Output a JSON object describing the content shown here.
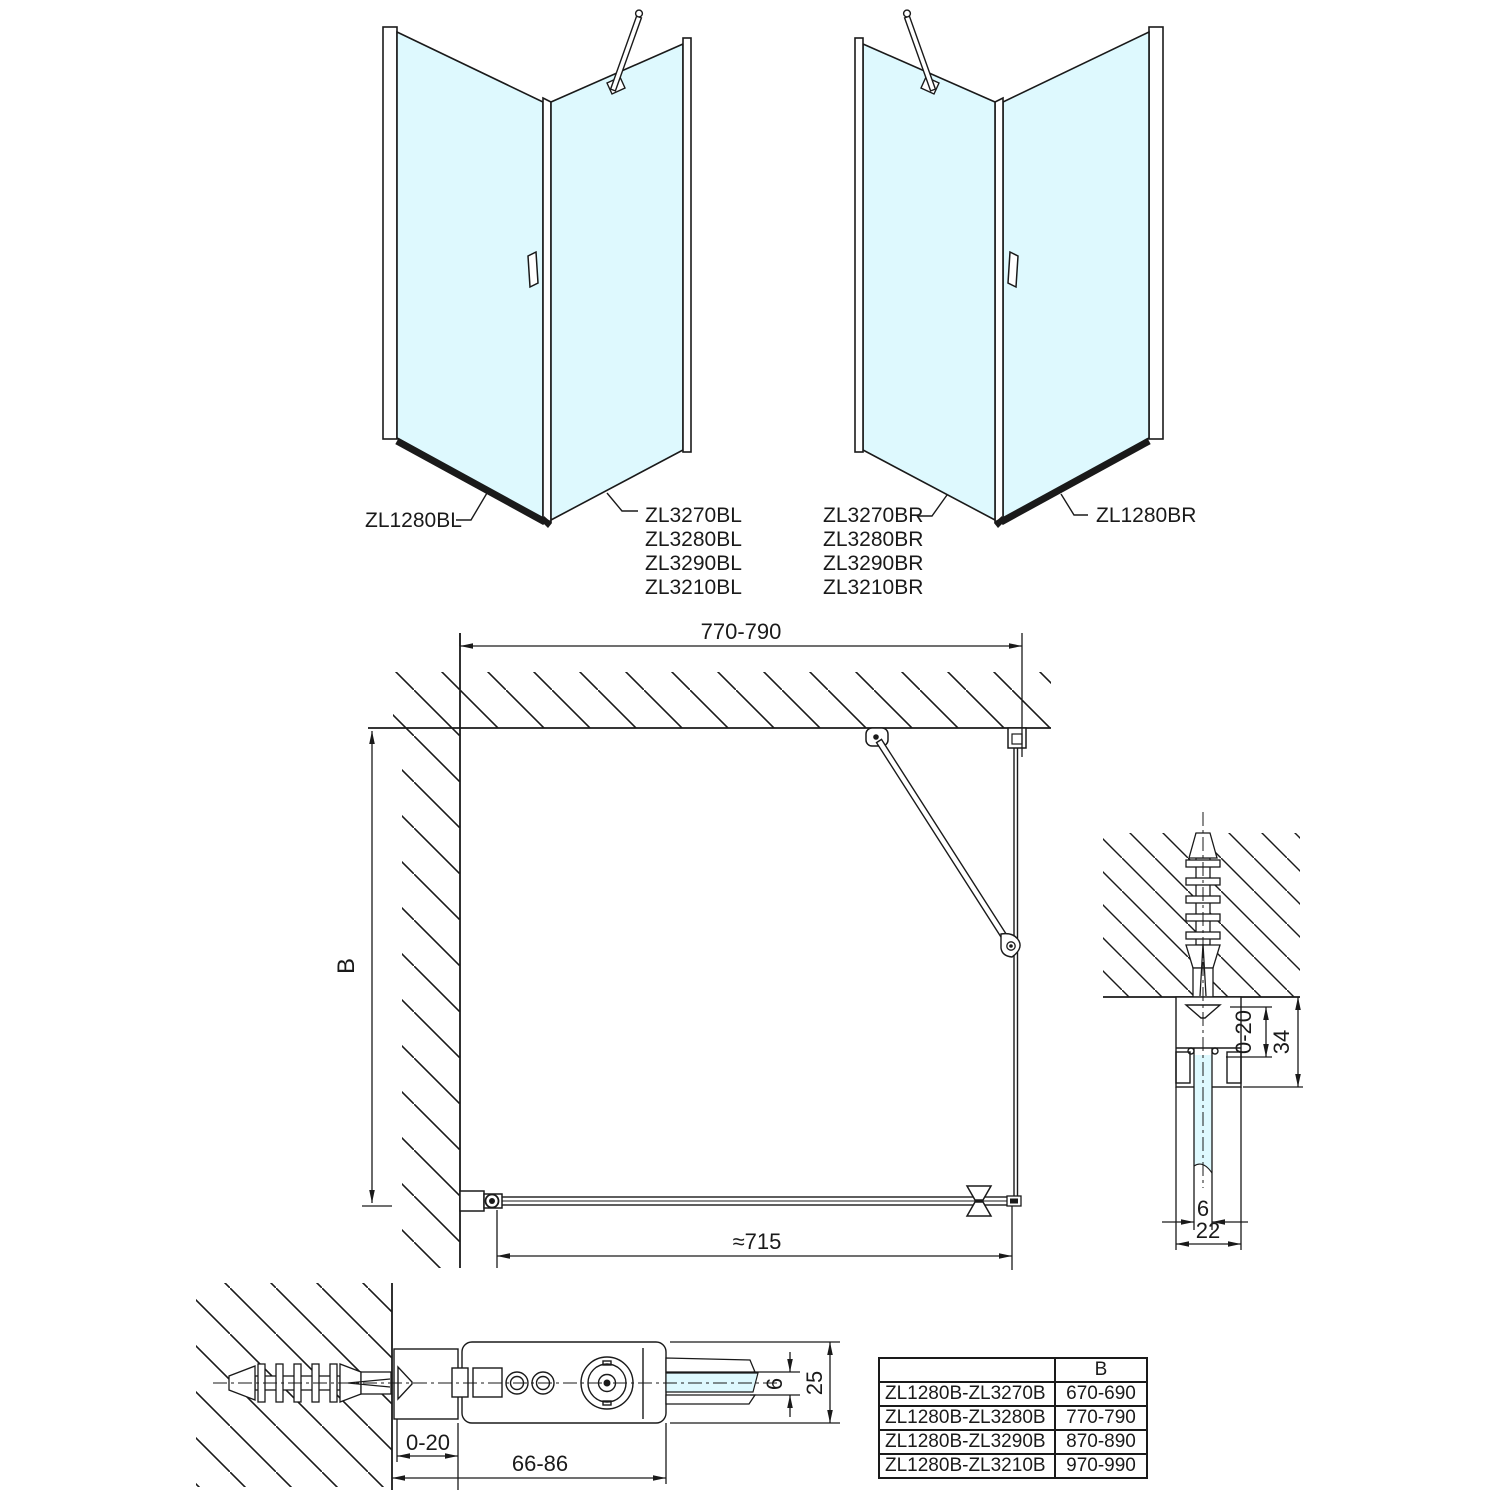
{
  "colors": {
    "glass": "#def9fe",
    "line": "#1a1a1a"
  },
  "views": {
    "left": {
      "side_panel": "ZL1280BL",
      "doors": [
        "ZL3270BL",
        "ZL3280BL",
        "ZL3290BL",
        "ZL3210BL"
      ]
    },
    "right": {
      "doors": [
        "ZL3270BR",
        "ZL3280BR",
        "ZL3290BR",
        "ZL3210BR"
      ],
      "side_panel": "ZL1280BR"
    }
  },
  "plan": {
    "width": "770-790",
    "depth": "B",
    "door_width": "≈715"
  },
  "wall_profile_detail": {
    "adjustment": "0-20",
    "depth": "34",
    "glass_thickness": "6",
    "width": "22"
  },
  "hinge_detail": {
    "adjustment": "0-20",
    "range": "66-86",
    "glass_thickness": "6",
    "height": "25"
  },
  "size_table": {
    "headers": [
      "",
      "B"
    ],
    "rows": [
      [
        "ZL1280B-ZL3270B",
        "670-690"
      ],
      [
        "ZL1280B-ZL3280B",
        "770-790"
      ],
      [
        "ZL1280B-ZL3290B",
        "870-890"
      ],
      [
        "ZL1280B-ZL3210B",
        "970-990"
      ]
    ]
  }
}
